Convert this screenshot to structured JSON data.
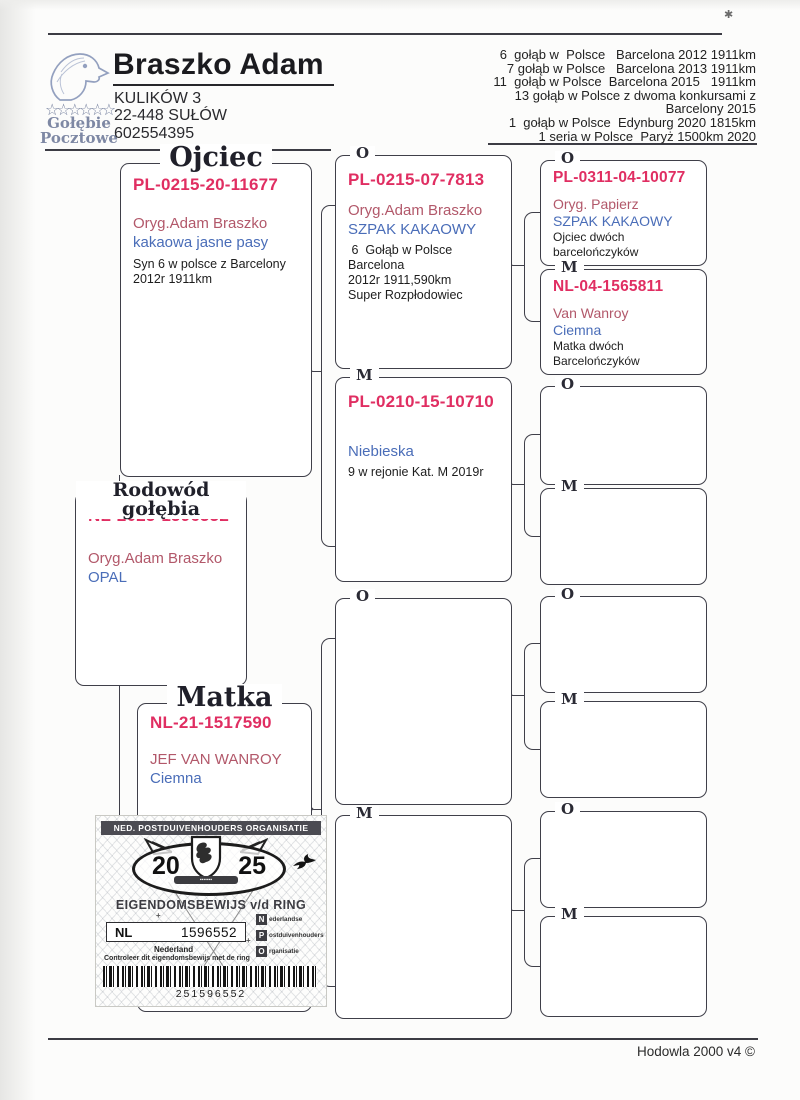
{
  "header": {
    "name": "Braszko Adam",
    "address": [
      "KULIKÓW 3",
      "22-448 SUŁÓW",
      "602554395"
    ],
    "logo": {
      "icon": "pigeon-head-icon",
      "stars": "☆☆☆☆☆☆",
      "line1": "Gołębie",
      "line2": "Pocztowe"
    }
  },
  "results": [
    "6  gołąb w  Polsce   Barcelona 2012 1911km",
    "7 gołąb w Polsce   Barcelona 2013 1911km",
    "11  gołąb w Polsce  Barcelona 2015   1911km",
    "13 gołąb w Polsce z dwoma konkursami z",
    "Barcelony 2015",
    "1  gołąb w Polsce  Edynburg 2020 1815km",
    "1 seria w Polsce  Paryż 1500km 2020"
  ],
  "pedigree": {
    "father": {
      "title": "Ojciec",
      "ring": "PL-0215-20-11677",
      "owner": "Oryg.Adam Braszko",
      "color": "kakaowa jasne pasy",
      "notes": [
        "Syn 6 w polsce z Barcelony",
        "2012r 1911km"
      ]
    },
    "subject": {
      "title": "Rodowód gołębia",
      "ring": "NL-2025-1596552",
      "owner": "Oryg.Adam Braszko",
      "color": "OPAL"
    },
    "mother": {
      "title": "Matka",
      "ring": "NL-21-1517590",
      "owner": "JEF VAN WANROY",
      "color": "Ciemna"
    },
    "gen2": [
      {
        "label": "O",
        "ring": "PL-0215-07-7813",
        "owner": "Oryg.Adam Braszko",
        "color": "SZPAK KAKAOWY",
        "notes": [
          " 6  Gołąb w Polsce Barcelona",
          "2012r 1911,590km",
          "Super Rozpłodowiec"
        ]
      },
      {
        "label": "M",
        "ring": "PL-0210-15-10710",
        "owner": "",
        "color": "Niebieska",
        "notes": [
          "9 w rejonie Kat. M 2019r"
        ]
      },
      {
        "label": "O"
      },
      {
        "label": "M"
      }
    ],
    "gen3": [
      {
        "label": "O",
        "ring": "PL-0311-04-10077",
        "owner": "Oryg. Papierz",
        "color": "SZPAK KAKAOWY",
        "notes": [
          "Ojciec dwóch barcelończyków"
        ]
      },
      {
        "label": "M",
        "ring": "NL-04-1565811",
        "owner": "Van Wanroy",
        "color": "Ciemna",
        "notes": [
          "Matka dwóch Barcelończyków"
        ]
      },
      {
        "label": "O"
      },
      {
        "label": "M"
      },
      {
        "label": "O"
      },
      {
        "label": "M"
      },
      {
        "label": "O"
      },
      {
        "label": "M"
      }
    ]
  },
  "stamp": {
    "org_title": "NED. POSTDUIVENHOUDERS ORGANISATIE",
    "year_left": "20",
    "year_right": "25",
    "ownership_title": "EIGENDOMSBEWIJS v/d RING",
    "country_code": "NL",
    "ring_number": "1596552",
    "country": "Nederland",
    "npo": [
      {
        "initial": "N",
        "rest": "ederlandse"
      },
      {
        "initial": "P",
        "rest": "ostduivenhouders"
      },
      {
        "initial": "O",
        "rest": "rganisatie"
      }
    ],
    "control_text": "Controleer dit eigendomsbewijs met de ring",
    "barcode_number": "251596552"
  },
  "footer": {
    "software": "Hodowla 2000 v4 ©"
  },
  "colors": {
    "ring": "#e02e62",
    "owner": "#b2586a",
    "blue": "#4a6db8",
    "ink": "#3f3f49"
  }
}
